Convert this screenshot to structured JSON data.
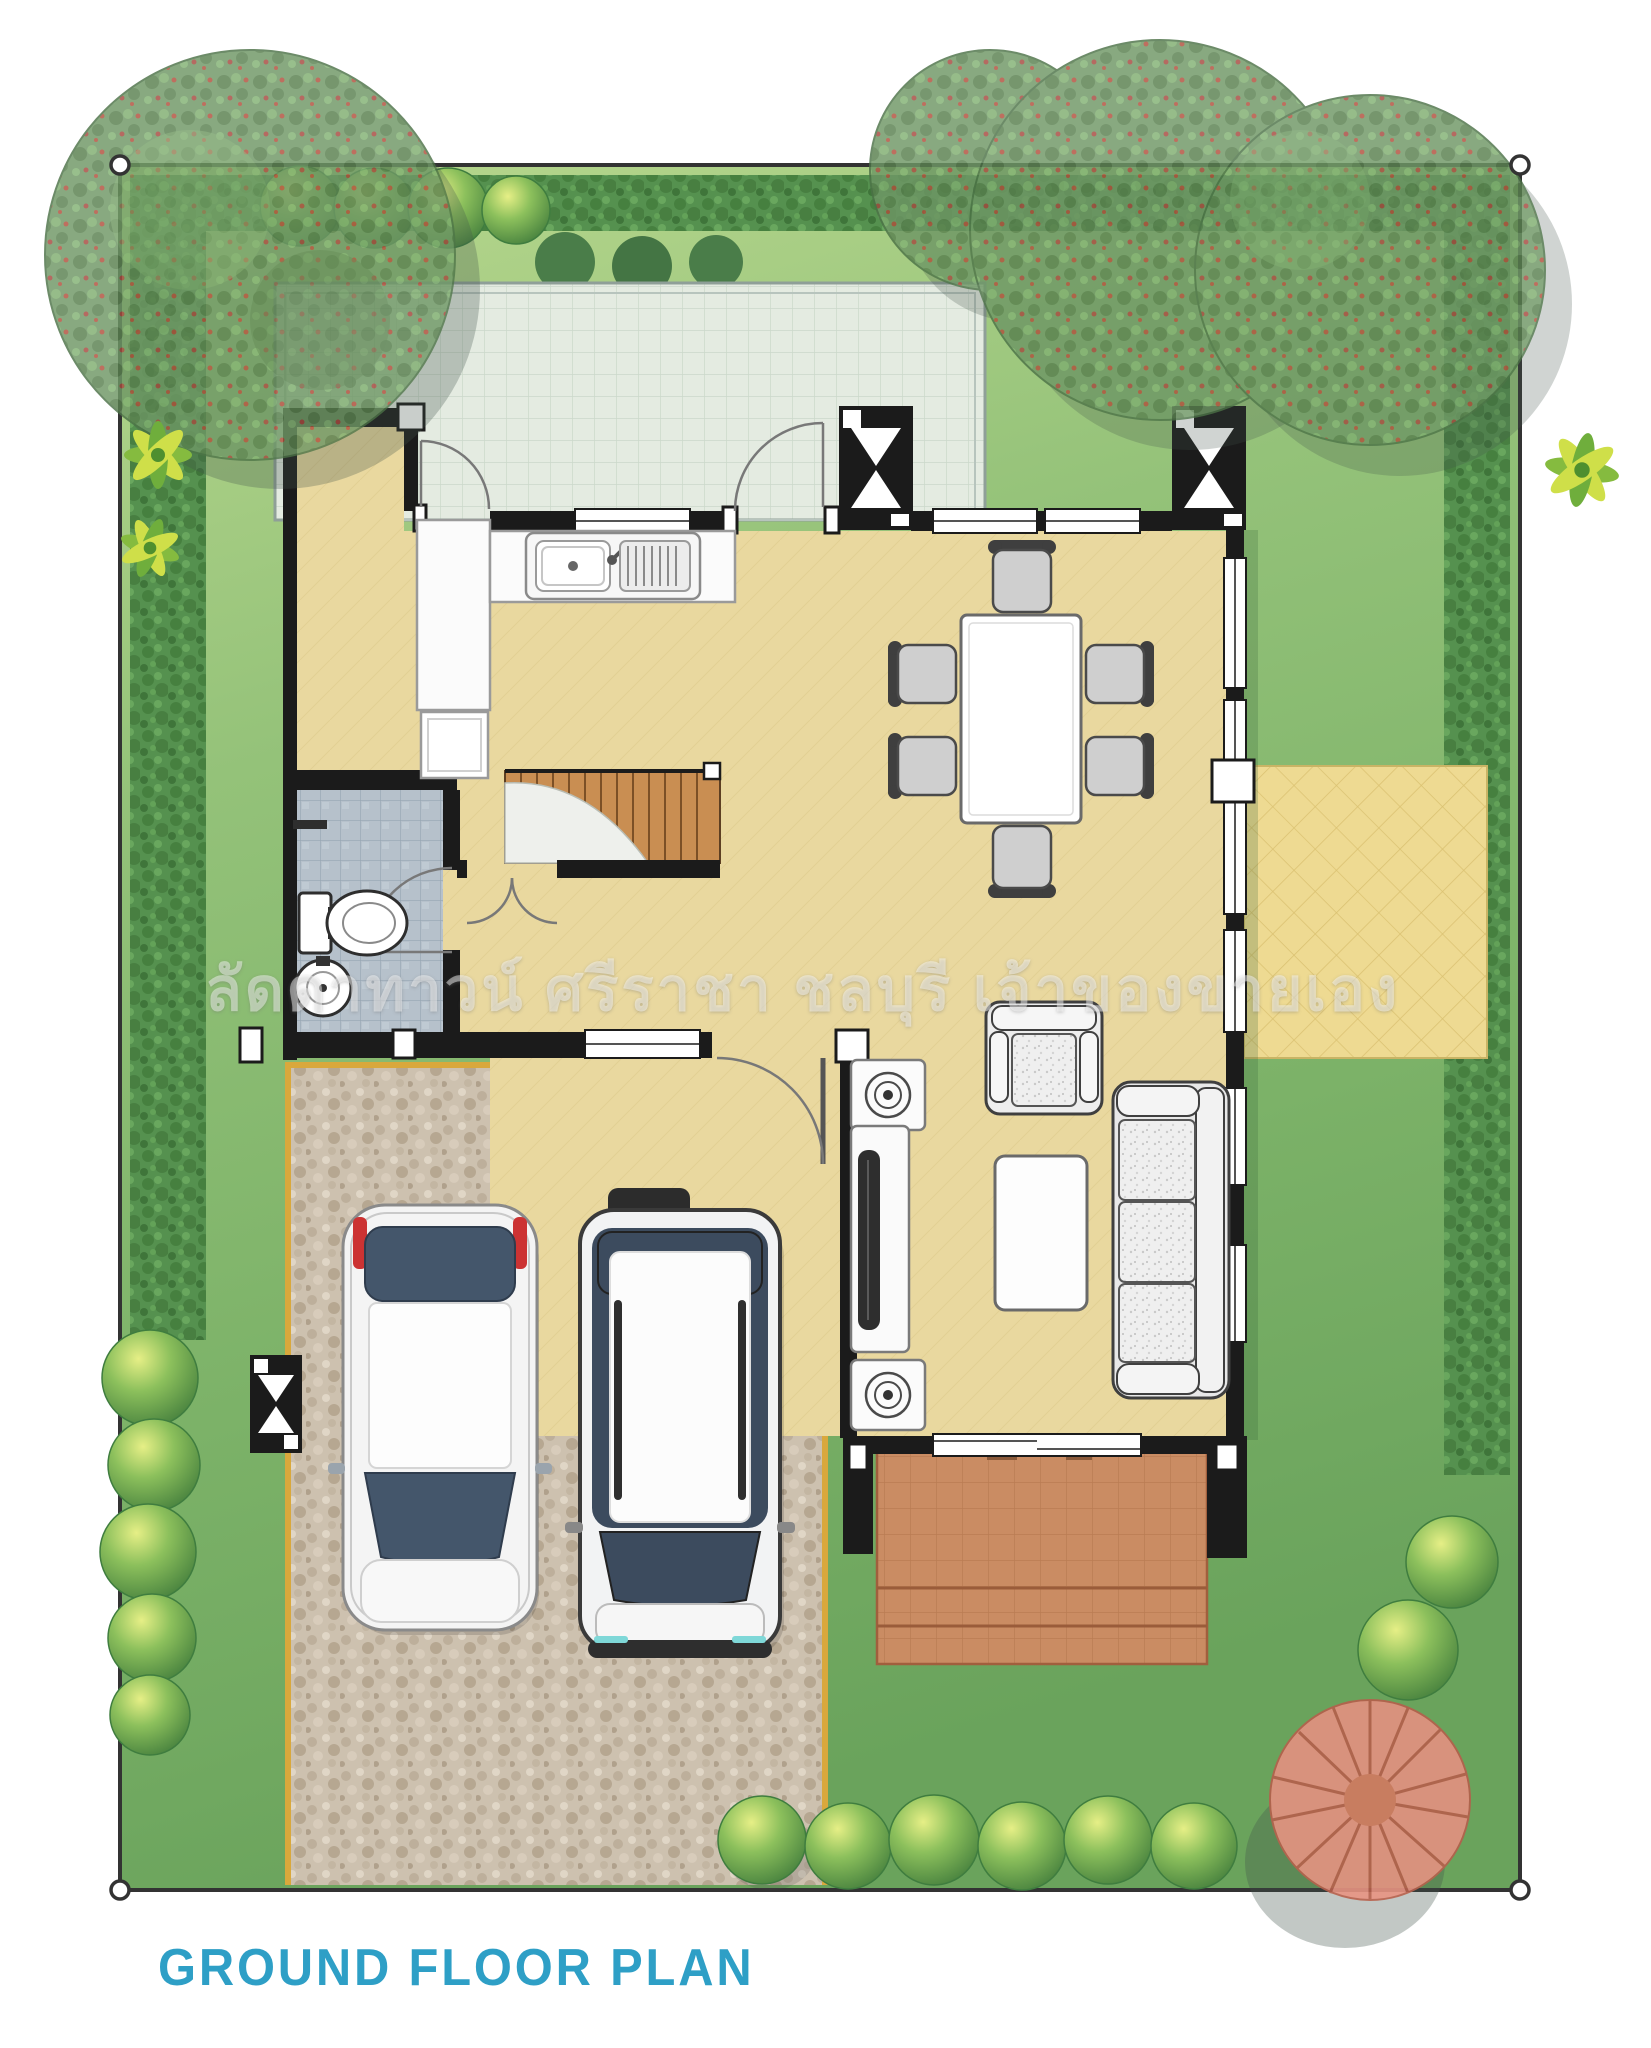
{
  "title": {
    "text": "GROUND FLOOR PLAN",
    "color": "#2E9FC6"
  },
  "watermark": {
    "text": "ลัดดาทาวน์ ศรีราชา ชลบุรี เจ้าของขายเอง",
    "color": "rgba(255,255,255,0.45)"
  },
  "palette": {
    "boundary_line": "#333333",
    "lawn_light": "#b9d88e",
    "lawn_dark": "#6aa35c",
    "hedge_green": "#55914f",
    "wall_black": "#1b1b1b",
    "floor_tan": "#e9d89f",
    "bathroom_tile": "#b6c1cb",
    "back_patio_mint": "#e4ebe1",
    "terrace_terracotta": "#ca8c63",
    "side_patio_yellow": "#eeda92",
    "driveway_pebble": "#cdc1af",
    "curb_yellow": "#d9a83c",
    "tree_green": "#6e9765",
    "tree_red": "#e29180",
    "car_glass": "#3c4b5e",
    "stair_wood": "#c98e52",
    "title_teal": "#2E9FC6"
  }
}
